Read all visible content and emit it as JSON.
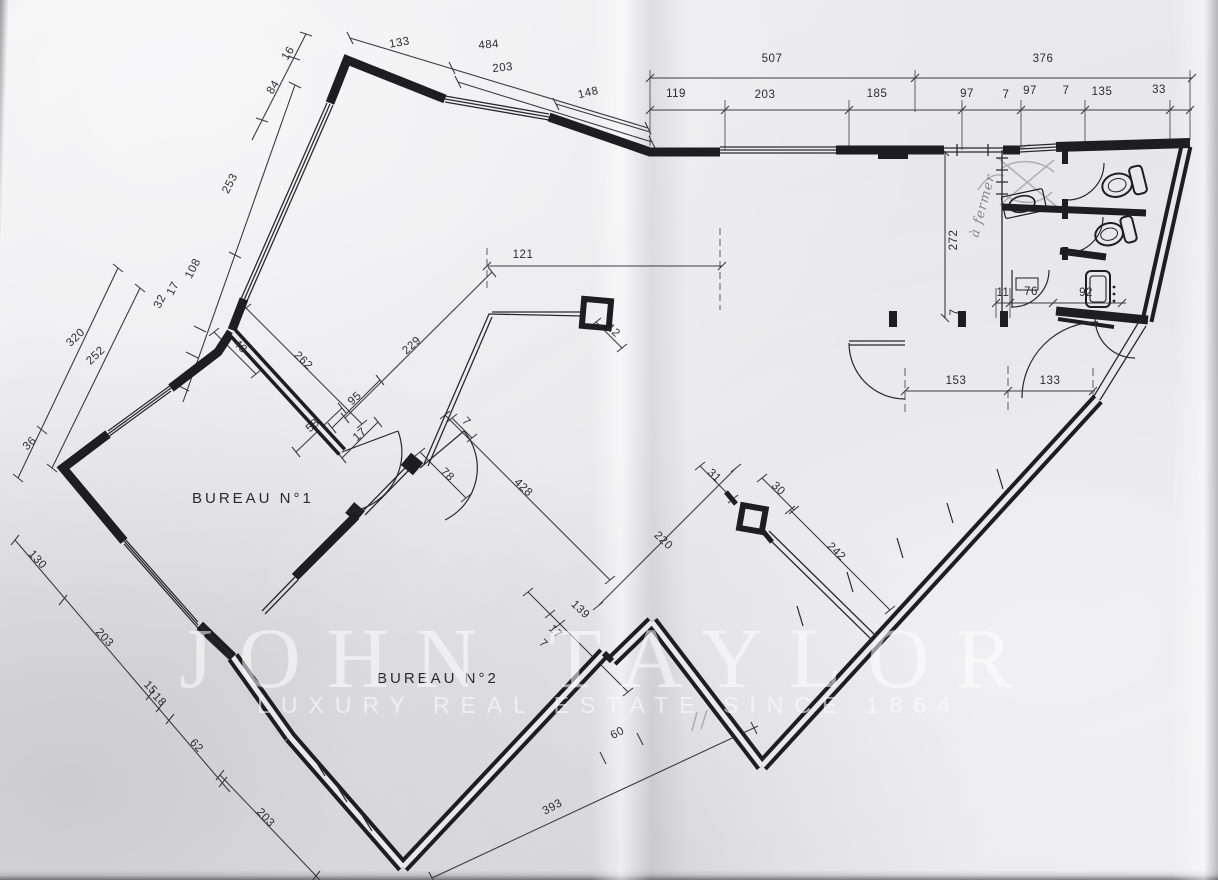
{
  "rooms": {
    "bureau1": "BUREAU  N°1",
    "bureau2": "BUREAU  N°2"
  },
  "annotations": {
    "handwritten_note": "à fermer"
  },
  "watermark": {
    "line1": "JOHN TAYLOR",
    "line2": "LUXURY REAL ESTATE SINCE 1864"
  },
  "colors": {
    "paper": "#e9e9ec",
    "ink": "#1e1e20",
    "dimension_ink": "#3c3c40",
    "pencil": "#a0a0a6",
    "watermark": "#ffffff"
  },
  "icons": [
    "toilet-icon",
    "toilet-icon",
    "sink-icon",
    "water-heater-icon"
  ],
  "dimensions": [
    {
      "v": "16",
      "x": 291,
      "y": 55,
      "r": -58
    },
    {
      "v": "84",
      "x": 276,
      "y": 89,
      "r": -58
    },
    {
      "v": "133",
      "x": 400,
      "y": 46,
      "r": -10
    },
    {
      "v": "484",
      "x": 489,
      "y": 48,
      "r": -5
    },
    {
      "v": "203",
      "x": 503,
      "y": 71,
      "r": -6
    },
    {
      "v": "148",
      "x": 589,
      "y": 96,
      "r": -13
    },
    {
      "v": "507",
      "x": 772,
      "y": 62,
      "r": 0
    },
    {
      "v": "376",
      "x": 1043,
      "y": 62,
      "r": 0
    },
    {
      "v": "119",
      "x": 676,
      "y": 97,
      "r": 0
    },
    {
      "v": "203",
      "x": 765,
      "y": 98,
      "r": 0
    },
    {
      "v": "185",
      "x": 877,
      "y": 97,
      "r": 0
    },
    {
      "v": "97",
      "x": 967,
      "y": 97,
      "r": 0
    },
    {
      "v": "7",
      "x": 1006,
      "y": 98,
      "r": 0
    },
    {
      "v": "97",
      "x": 1030,
      "y": 94,
      "r": 0
    },
    {
      "v": "7",
      "x": 1066,
      "y": 94,
      "r": 0
    },
    {
      "v": "135",
      "x": 1102,
      "y": 95,
      "r": 0
    },
    {
      "v": "33",
      "x": 1159,
      "y": 93,
      "r": 0
    },
    {
      "v": "253",
      "x": 233,
      "y": 185,
      "r": -63
    },
    {
      "v": "108",
      "x": 196,
      "y": 270,
      "r": -63
    },
    {
      "v": "17",
      "x": 176,
      "y": 290,
      "r": -63
    },
    {
      "v": "32",
      "x": 163,
      "y": 303,
      "r": -63
    },
    {
      "v": "320",
      "x": 78,
      "y": 340,
      "r": -44
    },
    {
      "v": "252",
      "x": 98,
      "y": 358,
      "r": -44
    },
    {
      "v": "36",
      "x": 32,
      "y": 446,
      "r": -44
    },
    {
      "v": "121",
      "x": 523,
      "y": 258,
      "r": 0
    },
    {
      "v": "229",
      "x": 414,
      "y": 348,
      "r": -42
    },
    {
      "v": "48",
      "x": 238,
      "y": 349,
      "r": 44
    },
    {
      "v": "262",
      "x": 301,
      "y": 363,
      "r": 44
    },
    {
      "v": "95",
      "x": 357,
      "y": 401,
      "r": -42
    },
    {
      "v": "58",
      "x": 315,
      "y": 428,
      "r": -42
    },
    {
      "v": "17",
      "x": 362,
      "y": 437,
      "r": -42
    },
    {
      "v": "7",
      "x": 464,
      "y": 424,
      "r": 44
    },
    {
      "v": "78",
      "x": 445,
      "y": 477,
      "r": 44
    },
    {
      "v": "12",
      "x": 611,
      "y": 333,
      "r": 44
    },
    {
      "v": "272",
      "x": 957,
      "y": 240,
      "r": -90
    },
    {
      "v": "7",
      "x": 958,
      "y": 312,
      "r": -90
    },
    {
      "v": "11",
      "x": 1003,
      "y": 296,
      "r": 0
    },
    {
      "v": "76",
      "x": 1031,
      "y": 295,
      "r": 0
    },
    {
      "v": "92",
      "x": 1086,
      "y": 296,
      "r": 0
    },
    {
      "v": "153",
      "x": 956,
      "y": 384,
      "r": 0
    },
    {
      "v": "133",
      "x": 1050,
      "y": 384,
      "r": 0
    },
    {
      "v": "428",
      "x": 521,
      "y": 490,
      "r": 44
    },
    {
      "v": "220",
      "x": 661,
      "y": 543,
      "r": 44
    },
    {
      "v": "31",
      "x": 712,
      "y": 478,
      "r": 44
    },
    {
      "v": "30",
      "x": 776,
      "y": 491,
      "r": 44
    },
    {
      "v": "242",
      "x": 834,
      "y": 554,
      "r": 44
    },
    {
      "v": "139",
      "x": 578,
      "y": 612,
      "r": 44
    },
    {
      "v": "17",
      "x": 553,
      "y": 634,
      "r": 44
    },
    {
      "v": "7",
      "x": 541,
      "y": 646,
      "r": 44
    },
    {
      "v": "130",
      "x": 35,
      "y": 562,
      "r": 47
    },
    {
      "v": "203",
      "x": 102,
      "y": 640,
      "r": 47
    },
    {
      "v": "15",
      "x": 148,
      "y": 690,
      "r": 47
    },
    {
      "v": "18",
      "x": 157,
      "y": 702,
      "r": 47
    },
    {
      "v": "62",
      "x": 194,
      "y": 748,
      "r": 47
    },
    {
      "v": "203",
      "x": 263,
      "y": 820,
      "r": 47
    },
    {
      "v": "393",
      "x": 554,
      "y": 810,
      "r": -28
    },
    {
      "v": "60",
      "x": 619,
      "y": 736,
      "r": -28
    }
  ]
}
